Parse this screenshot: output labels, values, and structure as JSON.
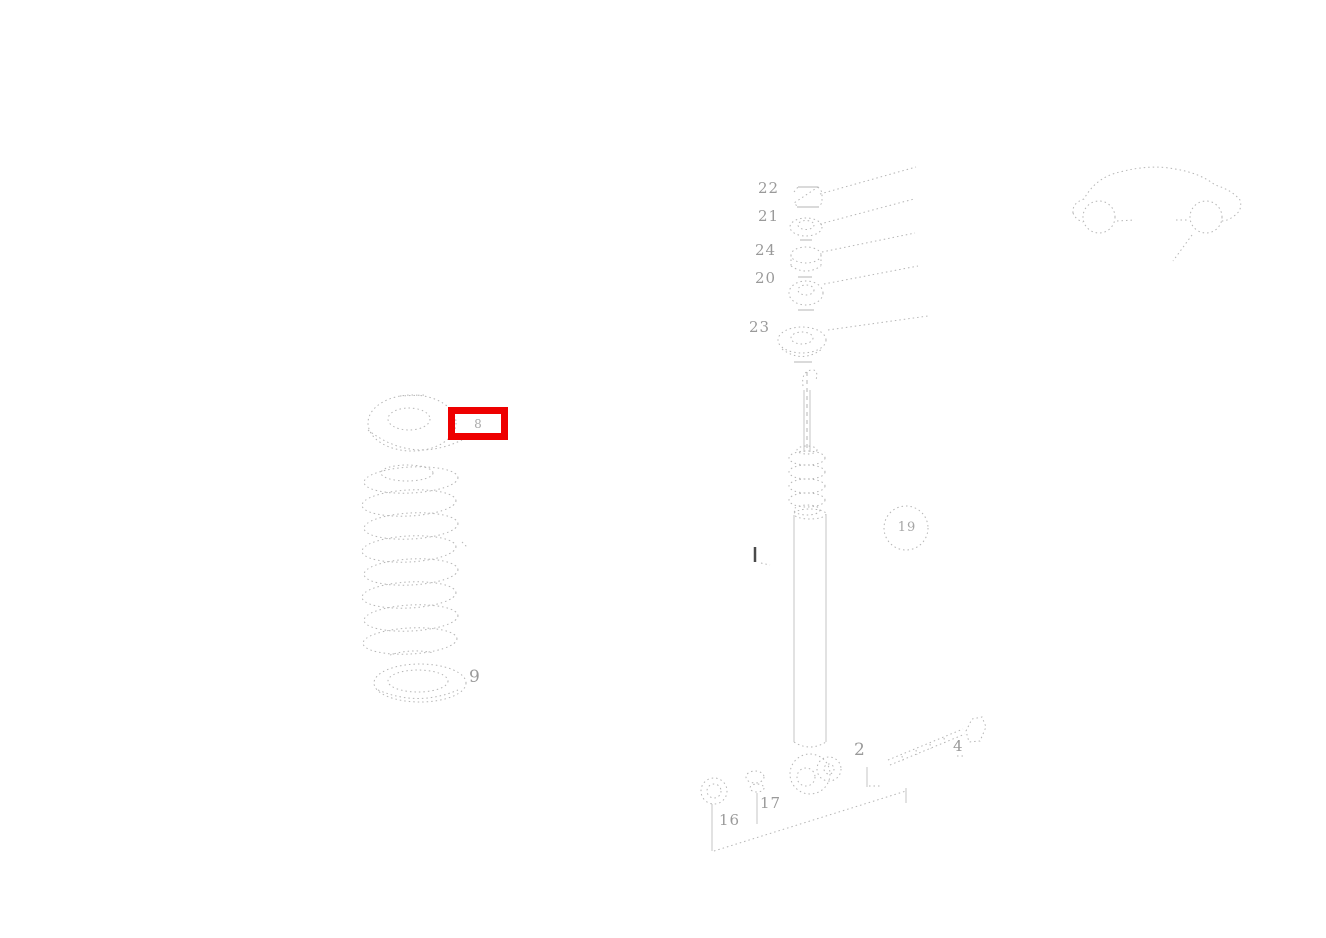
{
  "diagram": {
    "kind": "exploded-parts-line-drawing",
    "background_color": "#ffffff",
    "line_color": "#b5b5b5",
    "label_color": "#9a9a9a",
    "highlight_color": "#ee0000"
  },
  "highlight": {
    "label": "8"
  },
  "labels": {
    "l22": "22",
    "l21": "21",
    "l24": "24",
    "l20": "20",
    "l23": "23",
    "l8": "8",
    "l9": "9",
    "l19": "19",
    "l16": "16",
    "l17": "17",
    "l2": "2",
    "l4": "4"
  }
}
